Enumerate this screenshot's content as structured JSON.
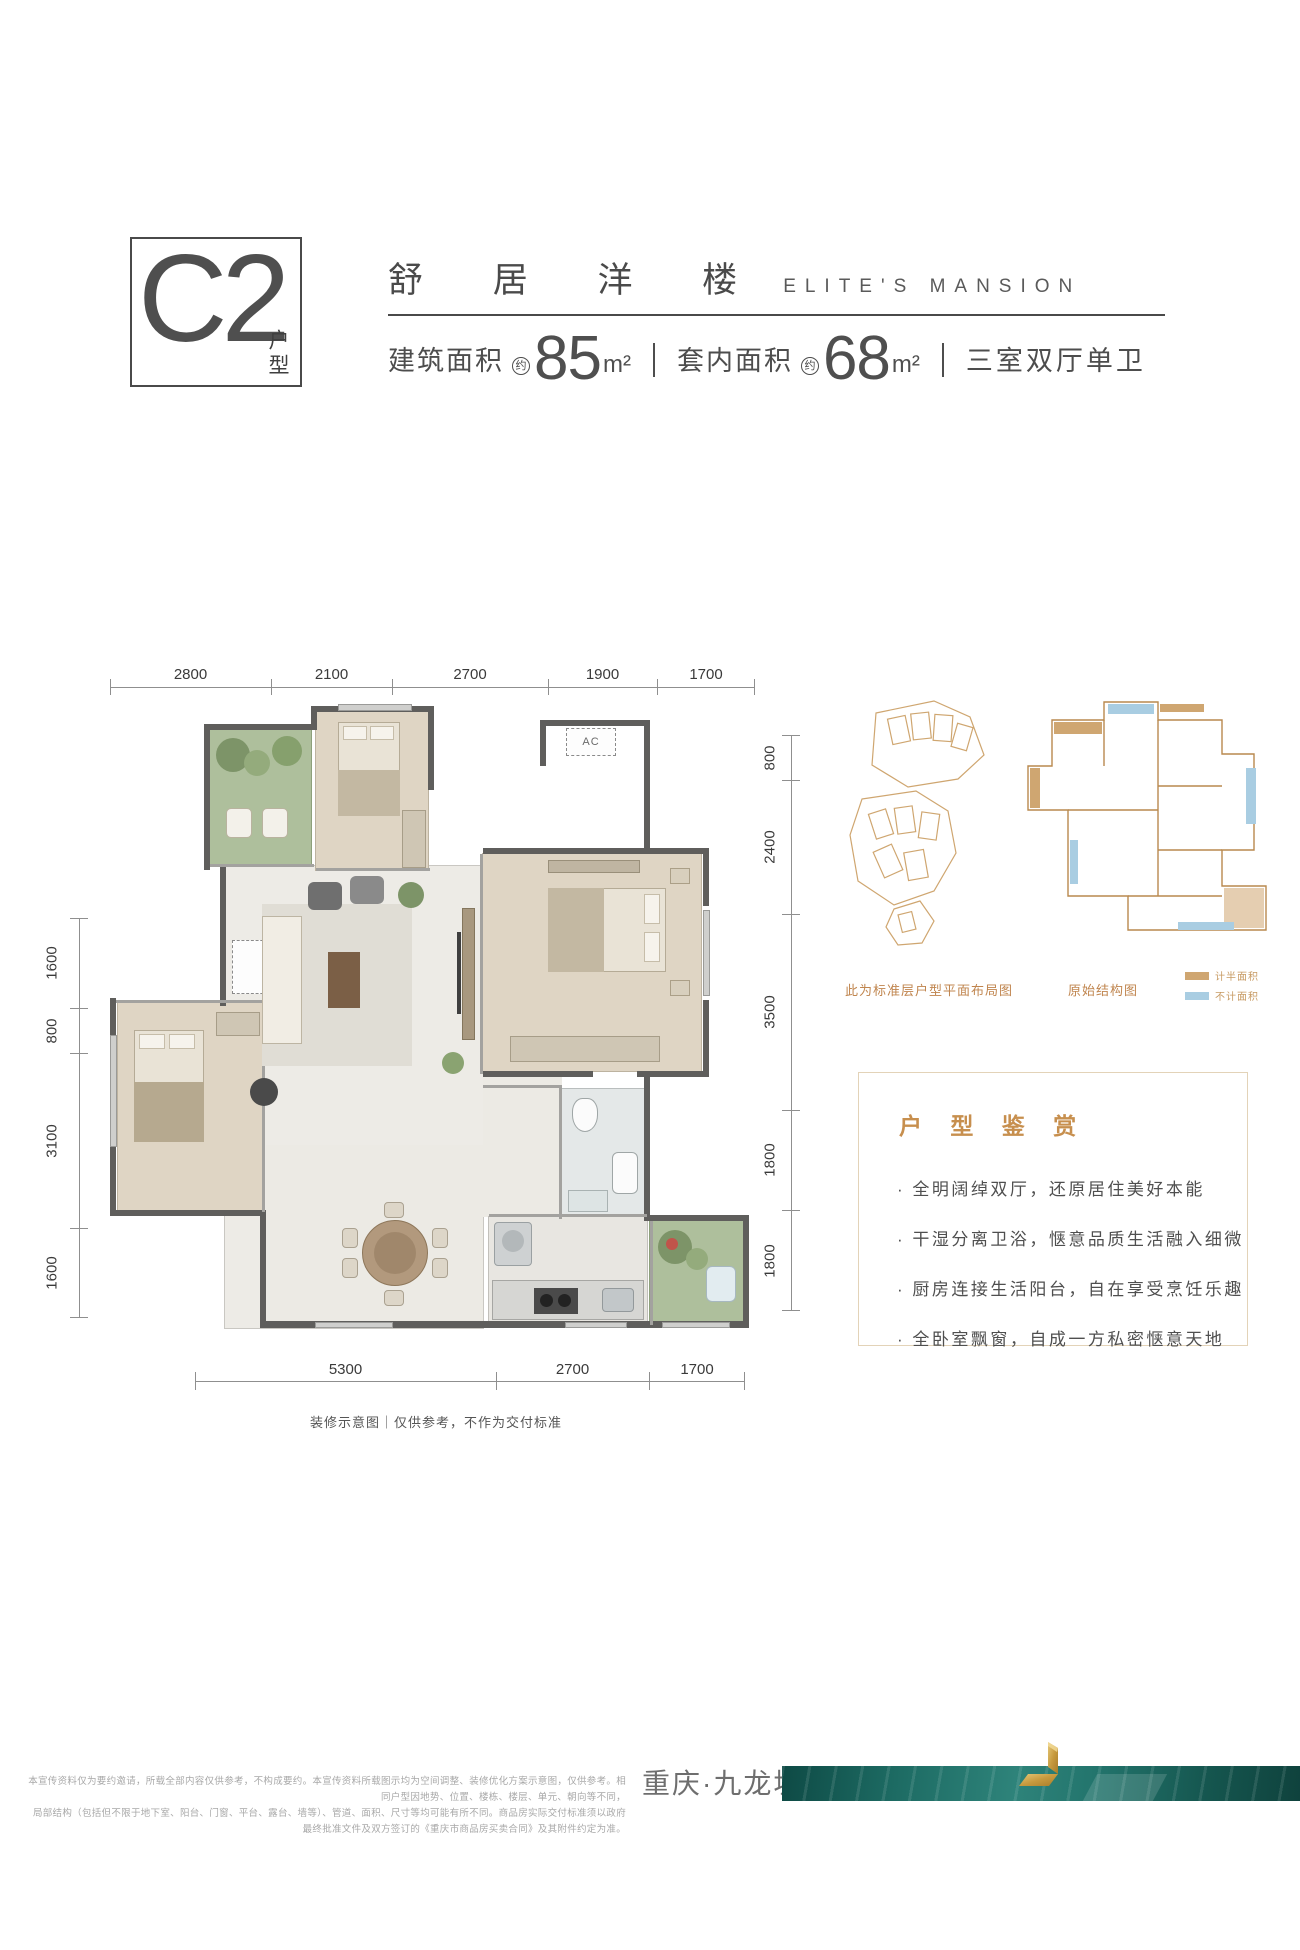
{
  "header": {
    "unit_code": "C2",
    "unit_suffix": "户型",
    "title_cn": "舒 居 洋 楼",
    "title_en": "ELITE'S MANSION",
    "approx": "约",
    "area_build_label": "建筑面积",
    "area_build_value": "85",
    "area_inner_label": "套内面积",
    "area_inner_value": "68",
    "area_unit": "m²",
    "layout_desc": "三室双厅单卫"
  },
  "floorplan": {
    "dims_top": [
      "2800",
      "2100",
      "2700",
      "1900",
      "1700"
    ],
    "dims_right": [
      "800",
      "2400",
      "3500",
      "1800",
      "1800"
    ],
    "dims_left": [
      "1600",
      "800",
      "3100",
      "1600"
    ],
    "dims_bottom": [
      "5300",
      "2700",
      "1700"
    ],
    "ac_label": "AC",
    "caption": "装修示意图｜仅供参考，不作为交付标准"
  },
  "minimaps": {
    "layout_caption": "此为标准层户型平面布局图",
    "structure_caption": "原始结构图",
    "legend": [
      {
        "label": "计半面积",
        "color": "#cfa671"
      },
      {
        "label": "不计面积",
        "color": "#a9cde2"
      }
    ]
  },
  "appreciation": {
    "title": "户 型 鉴 赏",
    "bullets": [
      "· 全明阔绰双厅，还原居住美好本能",
      "· 干湿分离卫浴，惬意品质生活融入细微",
      "· 厨房连接生活阳台，自在享受烹饪乐趣",
      "· 全卧室飘窗，自成一方私密惬意天地"
    ]
  },
  "footer": {
    "disclaimer_line1": "本宣传资料仅为要约邀请，所载全部内容仅供参考，不构成要约。本宣传资料所载图示均为空间调整、装修优化方案示意图，仅供参考。相同户型因地势、位置、楼栋、楼层、单元、朝向等不同，",
    "disclaimer_line2": "局部结构（包括但不限于地下室、阳台、门窗、平台、露台、墙等）、管道、面积、尺寸等均可能有所不同。商品房实际交付标准须以政府最终批准文件及双方签订的《重庆市商品房买卖合同》及其附件约定为准。",
    "location": "重庆·九龙坡·石杨路"
  },
  "colors": {
    "accent_tan": "#c78f4e",
    "legend_counted_half": "#cfa671",
    "legend_not_counted": "#a9cde2",
    "teal_bar": "#1d6b63",
    "gold_logo": "#c9a044"
  }
}
